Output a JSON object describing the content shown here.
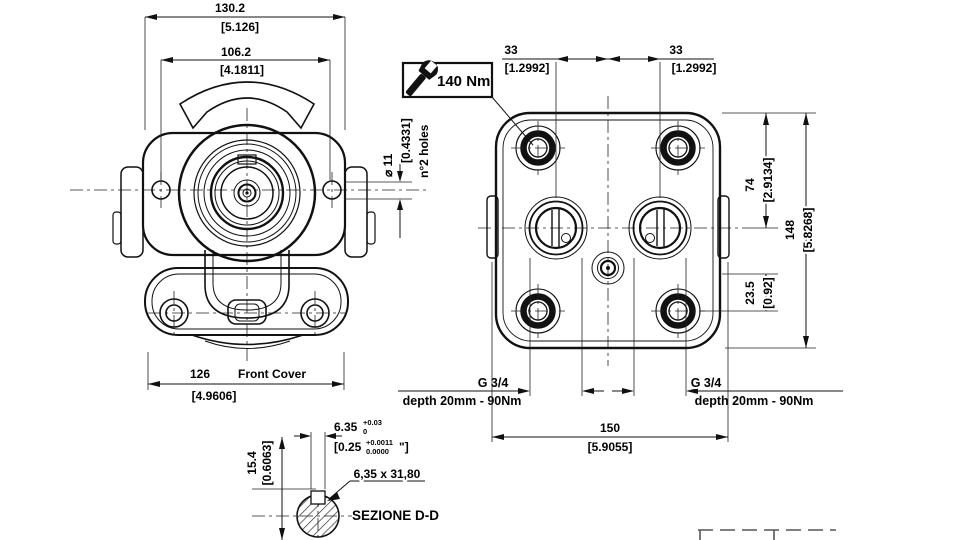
{
  "colors": {
    "line": "#111111",
    "background": "#ffffff"
  },
  "front": {
    "w_mm": "130.2",
    "w_in": "[5.126]",
    "holes_mm": "106.2",
    "holes_in": "[4.1811]",
    "cover_mm": "126",
    "cover_in": "[4.9606]",
    "cover_label": "Front Cover",
    "hole_dia": "⌀ 11",
    "hole_dia_in": "[0.4331]",
    "hole_note": "n°2 holes"
  },
  "rear": {
    "torque": "140 Nm",
    "off_l_mm": "33",
    "off_l_in": "[1.2992]",
    "off_r_mm": "33",
    "off_r_in": "[1.2992]",
    "h1_mm": "74",
    "h1_in": "[2.9134]",
    "h2_mm": "148",
    "h2_in": "[5.8268]",
    "h3_mm": "23.5",
    "h3_in": "[0.92]",
    "w_mm": "150",
    "w_in": "[5.9055]",
    "port_l_thread": "G 3/4",
    "port_l_depth": "depth 20mm - 90Nm",
    "port_r_thread": "G 3/4",
    "port_r_depth": "depth 20mm - 90Nm"
  },
  "section": {
    "title": "SEZIONE D-D",
    "key": "6,35 x 31,80",
    "key_w": "6.35",
    "key_w_sup": "+0.03",
    "key_w_sub": "0",
    "key_in_pre": "[0.25",
    "key_in_sup": "+0.0011",
    "key_in_sub": "0.0000",
    "key_in_suf": "\"]",
    "h_mm": "15.4",
    "h_in": "[0.6063]"
  }
}
